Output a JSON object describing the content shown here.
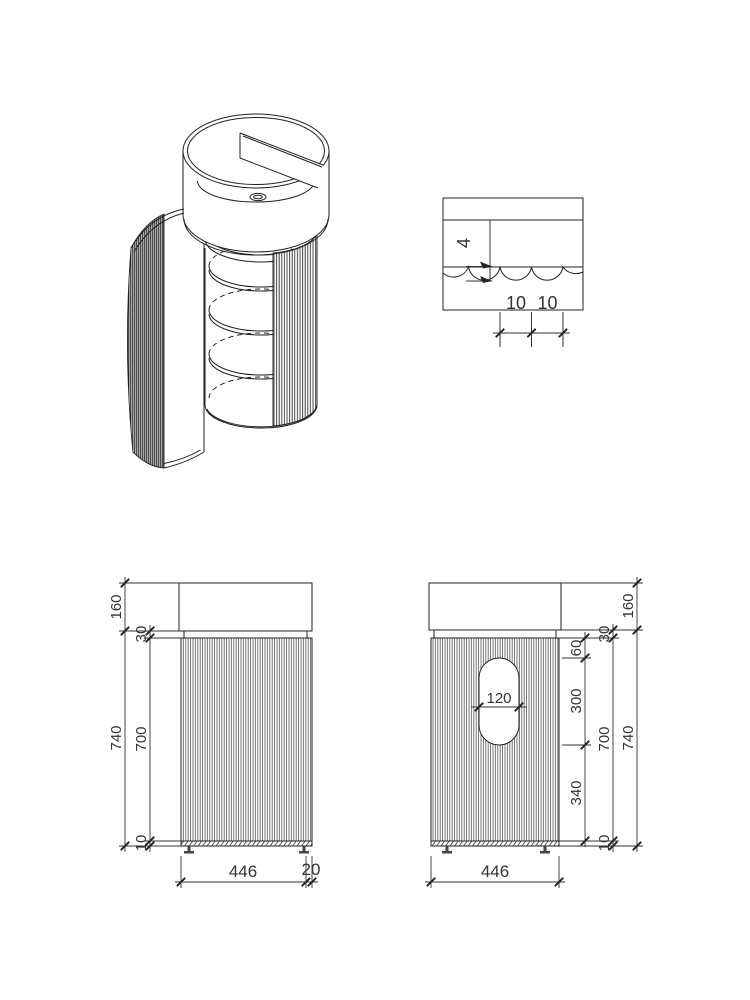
{
  "drawing": {
    "front": {
      "basin_height": "160",
      "top_gap": "30",
      "cabinet_height": "700",
      "total_height": "740",
      "bottom_gap": "10",
      "width": "446",
      "side_offset": "20"
    },
    "rear": {
      "basin_height": "160",
      "top_gap": "30",
      "cutout_offset_top": "60",
      "cutout_height": "300",
      "cutout_width": "120",
      "cutout_offset_bottom": "340",
      "cabinet_height": "700",
      "total_height": "740",
      "bottom_gap": "10",
      "width": "446"
    },
    "detail": {
      "flute_depth": "4",
      "pitch_a": "10",
      "pitch_b": "10"
    },
    "colors": {
      "line": "#222222",
      "dim_line": "#333333"
    }
  }
}
